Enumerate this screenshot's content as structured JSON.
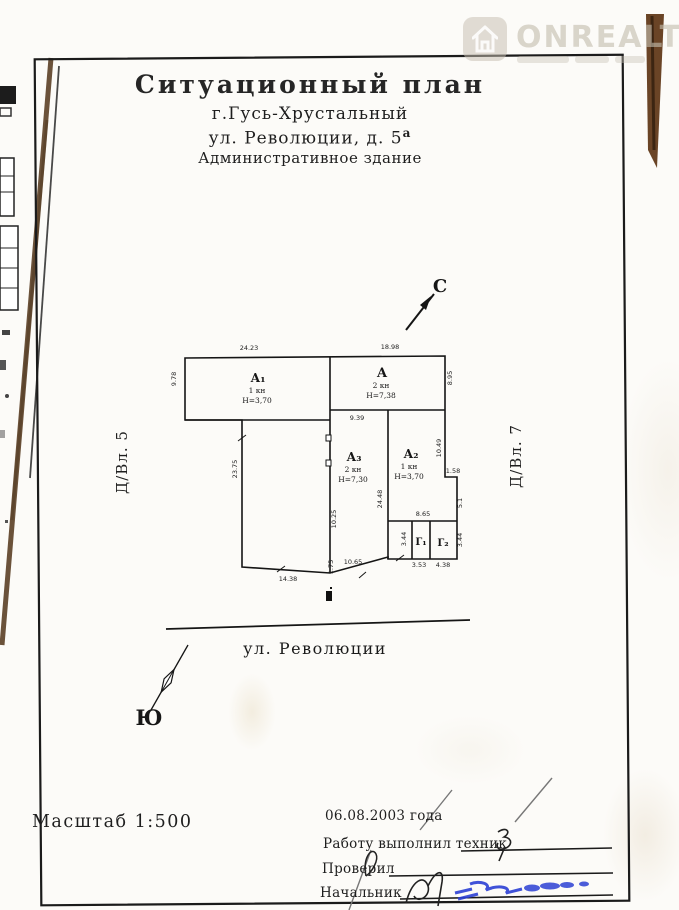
{
  "watermark": {
    "brand": "ONREALT",
    "icon": "house-icon"
  },
  "header": {
    "title": "Ситуационный план",
    "city": "г.Гусь-Хрустальный",
    "street": "ул. Революции, д. 5",
    "street_sup": "а",
    "building": "Административное здание"
  },
  "compass": {
    "north": "С",
    "south": "Ю"
  },
  "neighbors": {
    "left": "Д/Вл. 5",
    "right": "Д/Вл. 7"
  },
  "street_name": "ул. Революции",
  "plan": {
    "rooms": [
      {
        "name": "А₁",
        "storeys": "1 кн",
        "height": "Н=3,70"
      },
      {
        "name": "А",
        "storeys": "2 кн",
        "height": "Н=7,38"
      },
      {
        "name": "А₃",
        "storeys": "2 кн",
        "height": "Н=7,30"
      },
      {
        "name": "А₂",
        "storeys": "1 кн",
        "height": "Н=3,70"
      },
      {
        "name": "Г₁"
      },
      {
        "name": "Г₂"
      }
    ],
    "dims": [
      "24.23",
      "18.98",
      "9.78",
      "8.95",
      "9.39",
      "24.48",
      "10.25",
      "10.49",
      "1.58",
      "5.1",
      "8.65",
      "3.44",
      "3.44",
      "3.53",
      "4.38",
      "23.75",
      "14.38",
      "10.65",
      "1.75"
    ]
  },
  "footer": {
    "scale": "Масштаб 1:500",
    "date": "06.08.2003 года",
    "executed_by": "Работу выполнил техник",
    "checked_by": "Проверил",
    "chief": "Начальник"
  }
}
